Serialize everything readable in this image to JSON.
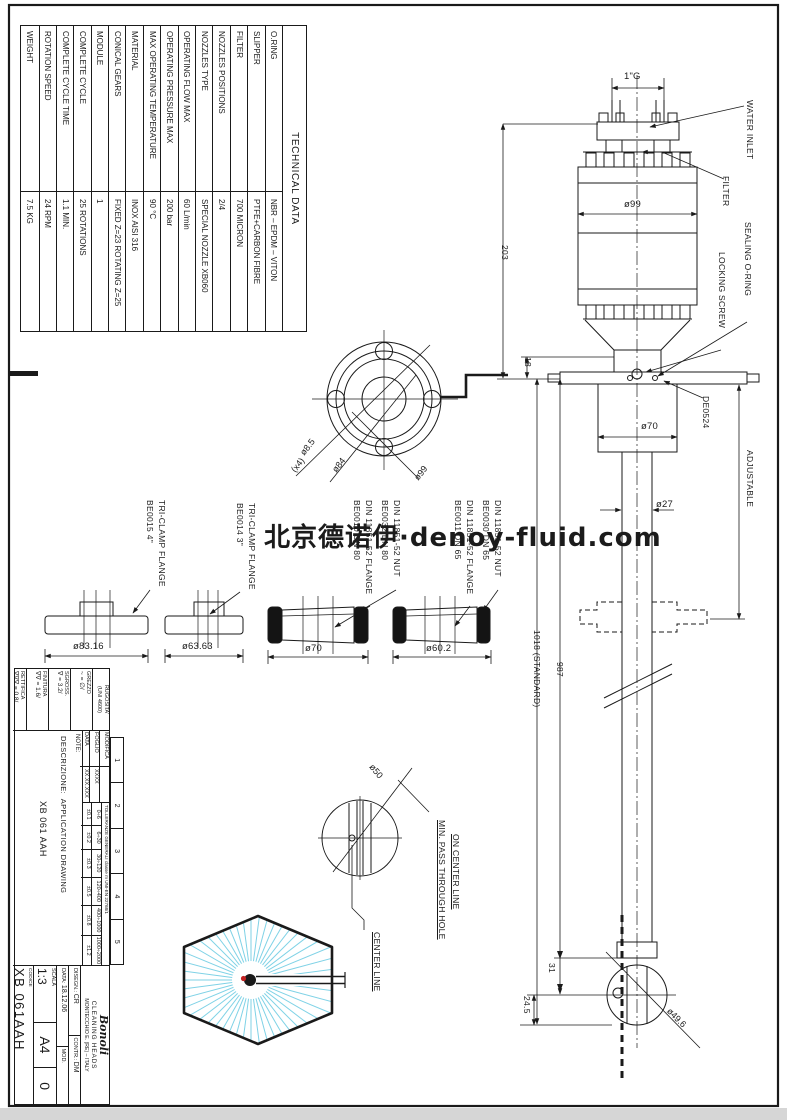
{
  "watermark": {
    "text": "北京德诺伊·denoy-fluid.com"
  },
  "technical_table": {
    "title": "TECHNICAL DATA",
    "rows": [
      {
        "label": "O.RING",
        "value": "NBR  –  EPDM  –  VITON"
      },
      {
        "label": "SLIPPER",
        "value": "PTFE+CARBON  FIBRE"
      },
      {
        "label": "FILTER",
        "value": "700 MICRON"
      },
      {
        "label": "NOZZLES  POSITIONS",
        "value": "2/4"
      },
      {
        "label": "NOZZLES  TYPE",
        "value": "SPECIAL  NOZZLE  XB060"
      },
      {
        "label": "OPERATING  FLOW  MAX",
        "value": "60  L/min"
      },
      {
        "label": "OPERATING  PRESSURE  MAX",
        "value": "200  bar"
      },
      {
        "label": "MAX  OPERATING  TEMPERATURE",
        "value": "90  °C"
      },
      {
        "label": "MATERIAL",
        "value": "INOX  AISI  316"
      },
      {
        "label": "CONICAL  GEARS",
        "value": "FIXED  Z=23  ROTATING  Z=25"
      },
      {
        "label": "MODULE",
        "value": "1"
      },
      {
        "label": "COMPLETE  CYCLE",
        "value": "25  ROTATIONS"
      },
      {
        "label": "COMPLETE  CYCLE  TIME",
        "value": "1.1  MIN."
      },
      {
        "label": "ROTATION  SPEED",
        "value": "24  RPM"
      },
      {
        "label": "WEIGHT",
        "value": "7.5  KG"
      }
    ]
  },
  "main_view": {
    "labels": {
      "water_inlet": "WATER  INLET",
      "filter": "FILTER",
      "sealing_oring": "SEALING  O-RING",
      "locking_screw": "LOCKING  SCREW",
      "de0524": "DE0524",
      "adjustable": "ADJUSTABLE"
    },
    "dims": {
      "inlet_thread": "1\"G",
      "body_dia": "ø99",
      "flange_dia": "ø70",
      "shaft_dia": "ø27",
      "height_top": "203",
      "flange_offset": "18",
      "length_standard": "1018  (STANDARD)",
      "length_to_center": "987",
      "head_offset": "31",
      "head_bottom": "24.5",
      "head_dia": "ø49.6"
    }
  },
  "flange_circle": {
    "bolt_holes": "ø8.5",
    "bolt_note": "(x4)",
    "bolt_circle": "ø84",
    "outer_dia": "ø99"
  },
  "pass_hole": {
    "dia": "ø50",
    "note_line1": "MIN.  PASS  THROUGH  HOLE",
    "note_line2": "ON  CENTER  LINE",
    "center_line": "CENTER  LINE"
  },
  "flanges": {
    "f1": {
      "code": "BE0015  4\"",
      "type": "TRI-CLAMP  FLANGE",
      "dia": "ø83.16"
    },
    "f2": {
      "code": "BE0014  3\"",
      "type": "TRI-CLAMP  FLANGE",
      "dia": "ø63.63"
    },
    "f3": {
      "flange_code": "BE0010  DN 80",
      "flange_type": "DIN 11851-52  FLANGE",
      "nut_code": "BE0032  DN 80",
      "nut_type": "DIN 11851-52  NUT",
      "dia": "ø70"
    },
    "f4": {
      "flange_code": "BE0011  DN 65",
      "flange_type": "DIN 11851-52  FLANGE",
      "nut_code": "BE0030  DN 65",
      "nut_type": "DIN 11851-52  NUT",
      "dia": "ø60.2"
    }
  },
  "title_block": {
    "roughness": {
      "title": "RUGOSITA'",
      "title2": "(UNI 4600)",
      "rows": [
        {
          "label": "GREZZO",
          "value": "~ = ∅/"
        },
        {
          "label": "SGROSS.",
          "value": "∇ = 3.2/"
        },
        {
          "label": "FINITURA",
          "value": "∇∇ = 1.6/"
        },
        {
          "label": "RETTIFICA",
          "value": "∇∇∇ = 0.8/"
        }
      ]
    },
    "revision": {
      "cols": [
        "1",
        "2",
        "3",
        "4",
        "5"
      ],
      "modifica": "MODIFICA",
      "foglio": "FOGLIO",
      "data": "DATA",
      "foglio_value": "XXXX",
      "data_value": "XX.XX.XXX"
    },
    "tolerances": {
      "header": "TOLLERANZE GENERALI   classe m   UNI-EN 22768/1",
      "ranges": [
        "0÷6",
        "6÷30",
        "30÷120",
        "120÷400",
        "400÷1000",
        "1000÷2000"
      ],
      "values": [
        "±0.1",
        "±0.2",
        "±0.3",
        "±0.5",
        "±0.8",
        "±1.2"
      ]
    },
    "note_label": "NOTE:",
    "description_label": "DESCRIZIONE:",
    "description_line1": "APPLICATION  DRAWING",
    "description_line2": "XB 061 AAH",
    "company": {
      "logo": "Bonoli",
      "line1": "CLEANING  HEADS",
      "line2": "MONTECCHIO E. (RE) – ITALY"
    },
    "fields": {
      "disegn_label": "DISEGN.:",
      "disegn": "CR",
      "contr_label": "CONTR.:",
      "contr": "DM",
      "mod_label": "MOD.",
      "data_label": "DATA:",
      "data": "18.12.06",
      "scala_label": "SCALA",
      "scala": "1:3",
      "format": "A4",
      "rev": "0",
      "codice_label": "CODICE",
      "codice": "XB 061AAH"
    }
  }
}
